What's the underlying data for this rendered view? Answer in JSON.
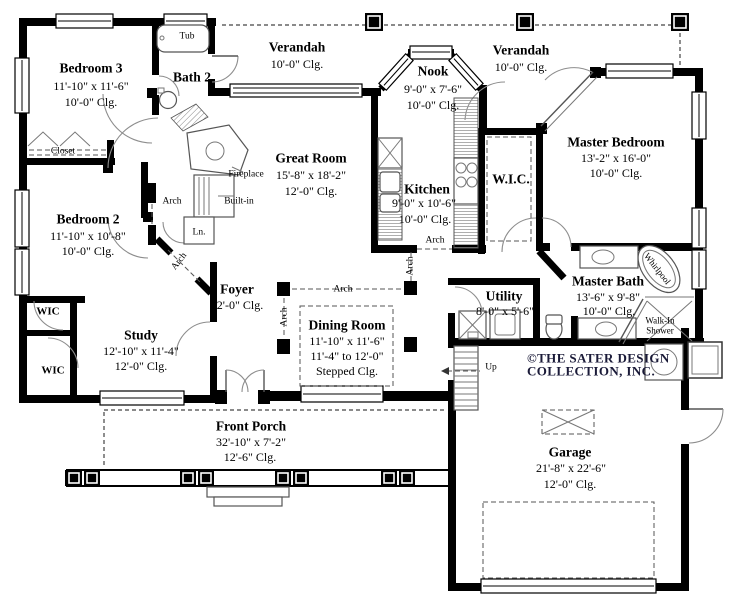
{
  "copyright": {
    "line1": "©THE SATER DESIGN",
    "line2": "COLLECTION, INC."
  },
  "colors": {
    "wall": "#000000",
    "copyright_text": "#1a1a38"
  },
  "rooms": {
    "bedroom3": {
      "name": "Bedroom 3",
      "dims": "11'-10\" x 11'-6\"",
      "ceiling": "10'-0\" Clg."
    },
    "bath2": {
      "name": "Bath 2"
    },
    "verandah_left": {
      "name": "Verandah",
      "ceiling": "10'-0\" Clg."
    },
    "nook": {
      "name": "Nook",
      "dims": "9'-0\" x 7'-6\"",
      "ceiling": "10'-0\" Clg."
    },
    "verandah_right": {
      "name": "Verandah",
      "ceiling": "10'-0\" Clg."
    },
    "master_bedroom": {
      "name": "Master Bedroom",
      "dims": "13'-2\" x 16'-0\"",
      "ceiling": "10'-0\" Clg."
    },
    "great_room": {
      "name": "Great Room",
      "dims": "15'-8\" x 18'-2\"",
      "ceiling": "12'-0\" Clg."
    },
    "kitchen": {
      "name": "Kitchen",
      "dims": "9'-0\" x 10'-6\"",
      "ceiling": "10'-0\" Clg."
    },
    "wic_master": {
      "name": "W.I.C."
    },
    "bedroom2": {
      "name": "Bedroom 2",
      "dims": "11'-10\" x 10'-8\"",
      "ceiling": "10'-0\" Clg."
    },
    "foyer": {
      "name": "Foyer",
      "ceiling": "12'-0\" Clg."
    },
    "study": {
      "name": "Study",
      "dims": "12'-10\" x 11'-4\"",
      "ceiling": "12'-0\" Clg."
    },
    "dining_room": {
      "name": "Dining Room",
      "dims": "11'-10\" x 11'-6\"",
      "dims2": "11'-4\" to 12'-0\"",
      "ceiling": "Stepped Clg."
    },
    "utility": {
      "name": "Utility",
      "dims": "8'-0\" x 5'-6\""
    },
    "master_bath": {
      "name": "Master Bath",
      "dims": "13'-6\" x 9'-8\"",
      "ceiling": "10'-0\" Clg."
    },
    "front_porch": {
      "name": "Front Porch",
      "dims": "32'-10\" x 7'-2\"",
      "ceiling": "12'-6\" Clg."
    },
    "garage": {
      "name": "Garage",
      "dims": "21'-8\" x 22'-6\"",
      "ceiling": "12'-0\" Clg."
    },
    "wic_upper": {
      "name": "WIC"
    },
    "wic_lower": {
      "name": "WIC"
    }
  },
  "fixtures": {
    "tub": "Tub",
    "closet": "Closet",
    "fireplace": "Fireplace",
    "built_in": "Built-in",
    "linen": "Ln.",
    "arch": "Arch",
    "whirlpool": "Whirlpool",
    "walk_in_line1": "Walk-In",
    "walk_in_line2": "Shower",
    "up": "Up"
  }
}
